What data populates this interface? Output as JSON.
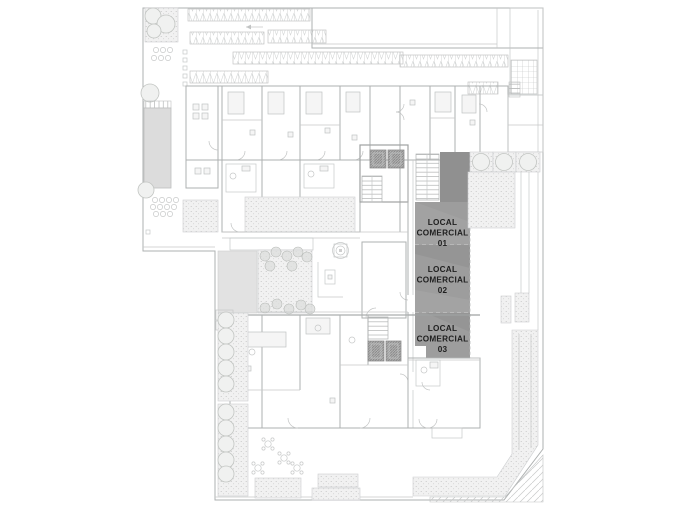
{
  "locales": [
    {
      "line1": "LOCAL",
      "line2": "COMERCIAL",
      "number": "01"
    },
    {
      "line1": "LOCAL",
      "line2": "COMERCIAL",
      "number": "02"
    },
    {
      "line1": "LOCAL",
      "line2": "COMERCIAL",
      "number": "03"
    }
  ],
  "colors": {
    "highlight": "#9d9d9d",
    "highlight_dark": "#8c8c8c",
    "label_text": "#1f1f1f",
    "line": "#b7b7b7",
    "background": "#ffffff"
  }
}
